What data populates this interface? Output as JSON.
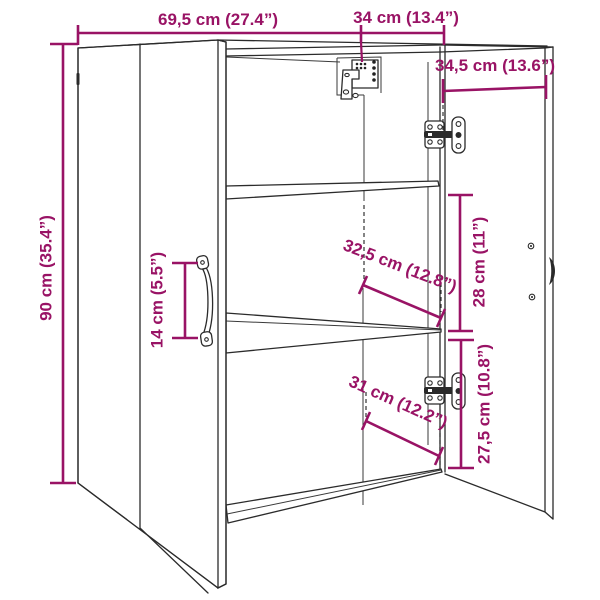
{
  "page": {
    "background": "#ffffff",
    "description": "Dimension diagram of a wall cabinet with one closed door, one open door, two inner shelves, hinges and wall-mount bracket"
  },
  "drawing": {
    "colors": {
      "dimension_accent": "#991365",
      "outline": "#2b2b2b",
      "background": "#ffffff"
    },
    "dimensions": {
      "total_width": "69,5 cm (27.4”)",
      "right_section_width": "34 cm (13.4”)",
      "door_width": "34,5 cm (13.6”)",
      "total_height": "90 cm (35.4”)",
      "handle_height": "14 cm (5.5”)",
      "inner_shelf_width": "32,5 cm (12.8”)",
      "middle_compartment_height": "28 cm (11”)",
      "inner_depth": "31 cm (12.2”)",
      "bottom_compartment_height": "27,5 cm (10.8”)"
    },
    "parts": {
      "left_door": "closed left door",
      "open_door": "open right door",
      "shelf_top": "upper shelf",
      "shelf_middle": "middle shelf",
      "bottom_panel": "bottom panel",
      "top_hinge": "top hinge",
      "bottom_hinge": "bottom hinge",
      "wall_bracket": "wall mount bracket",
      "door_handle": "door handle"
    }
  }
}
